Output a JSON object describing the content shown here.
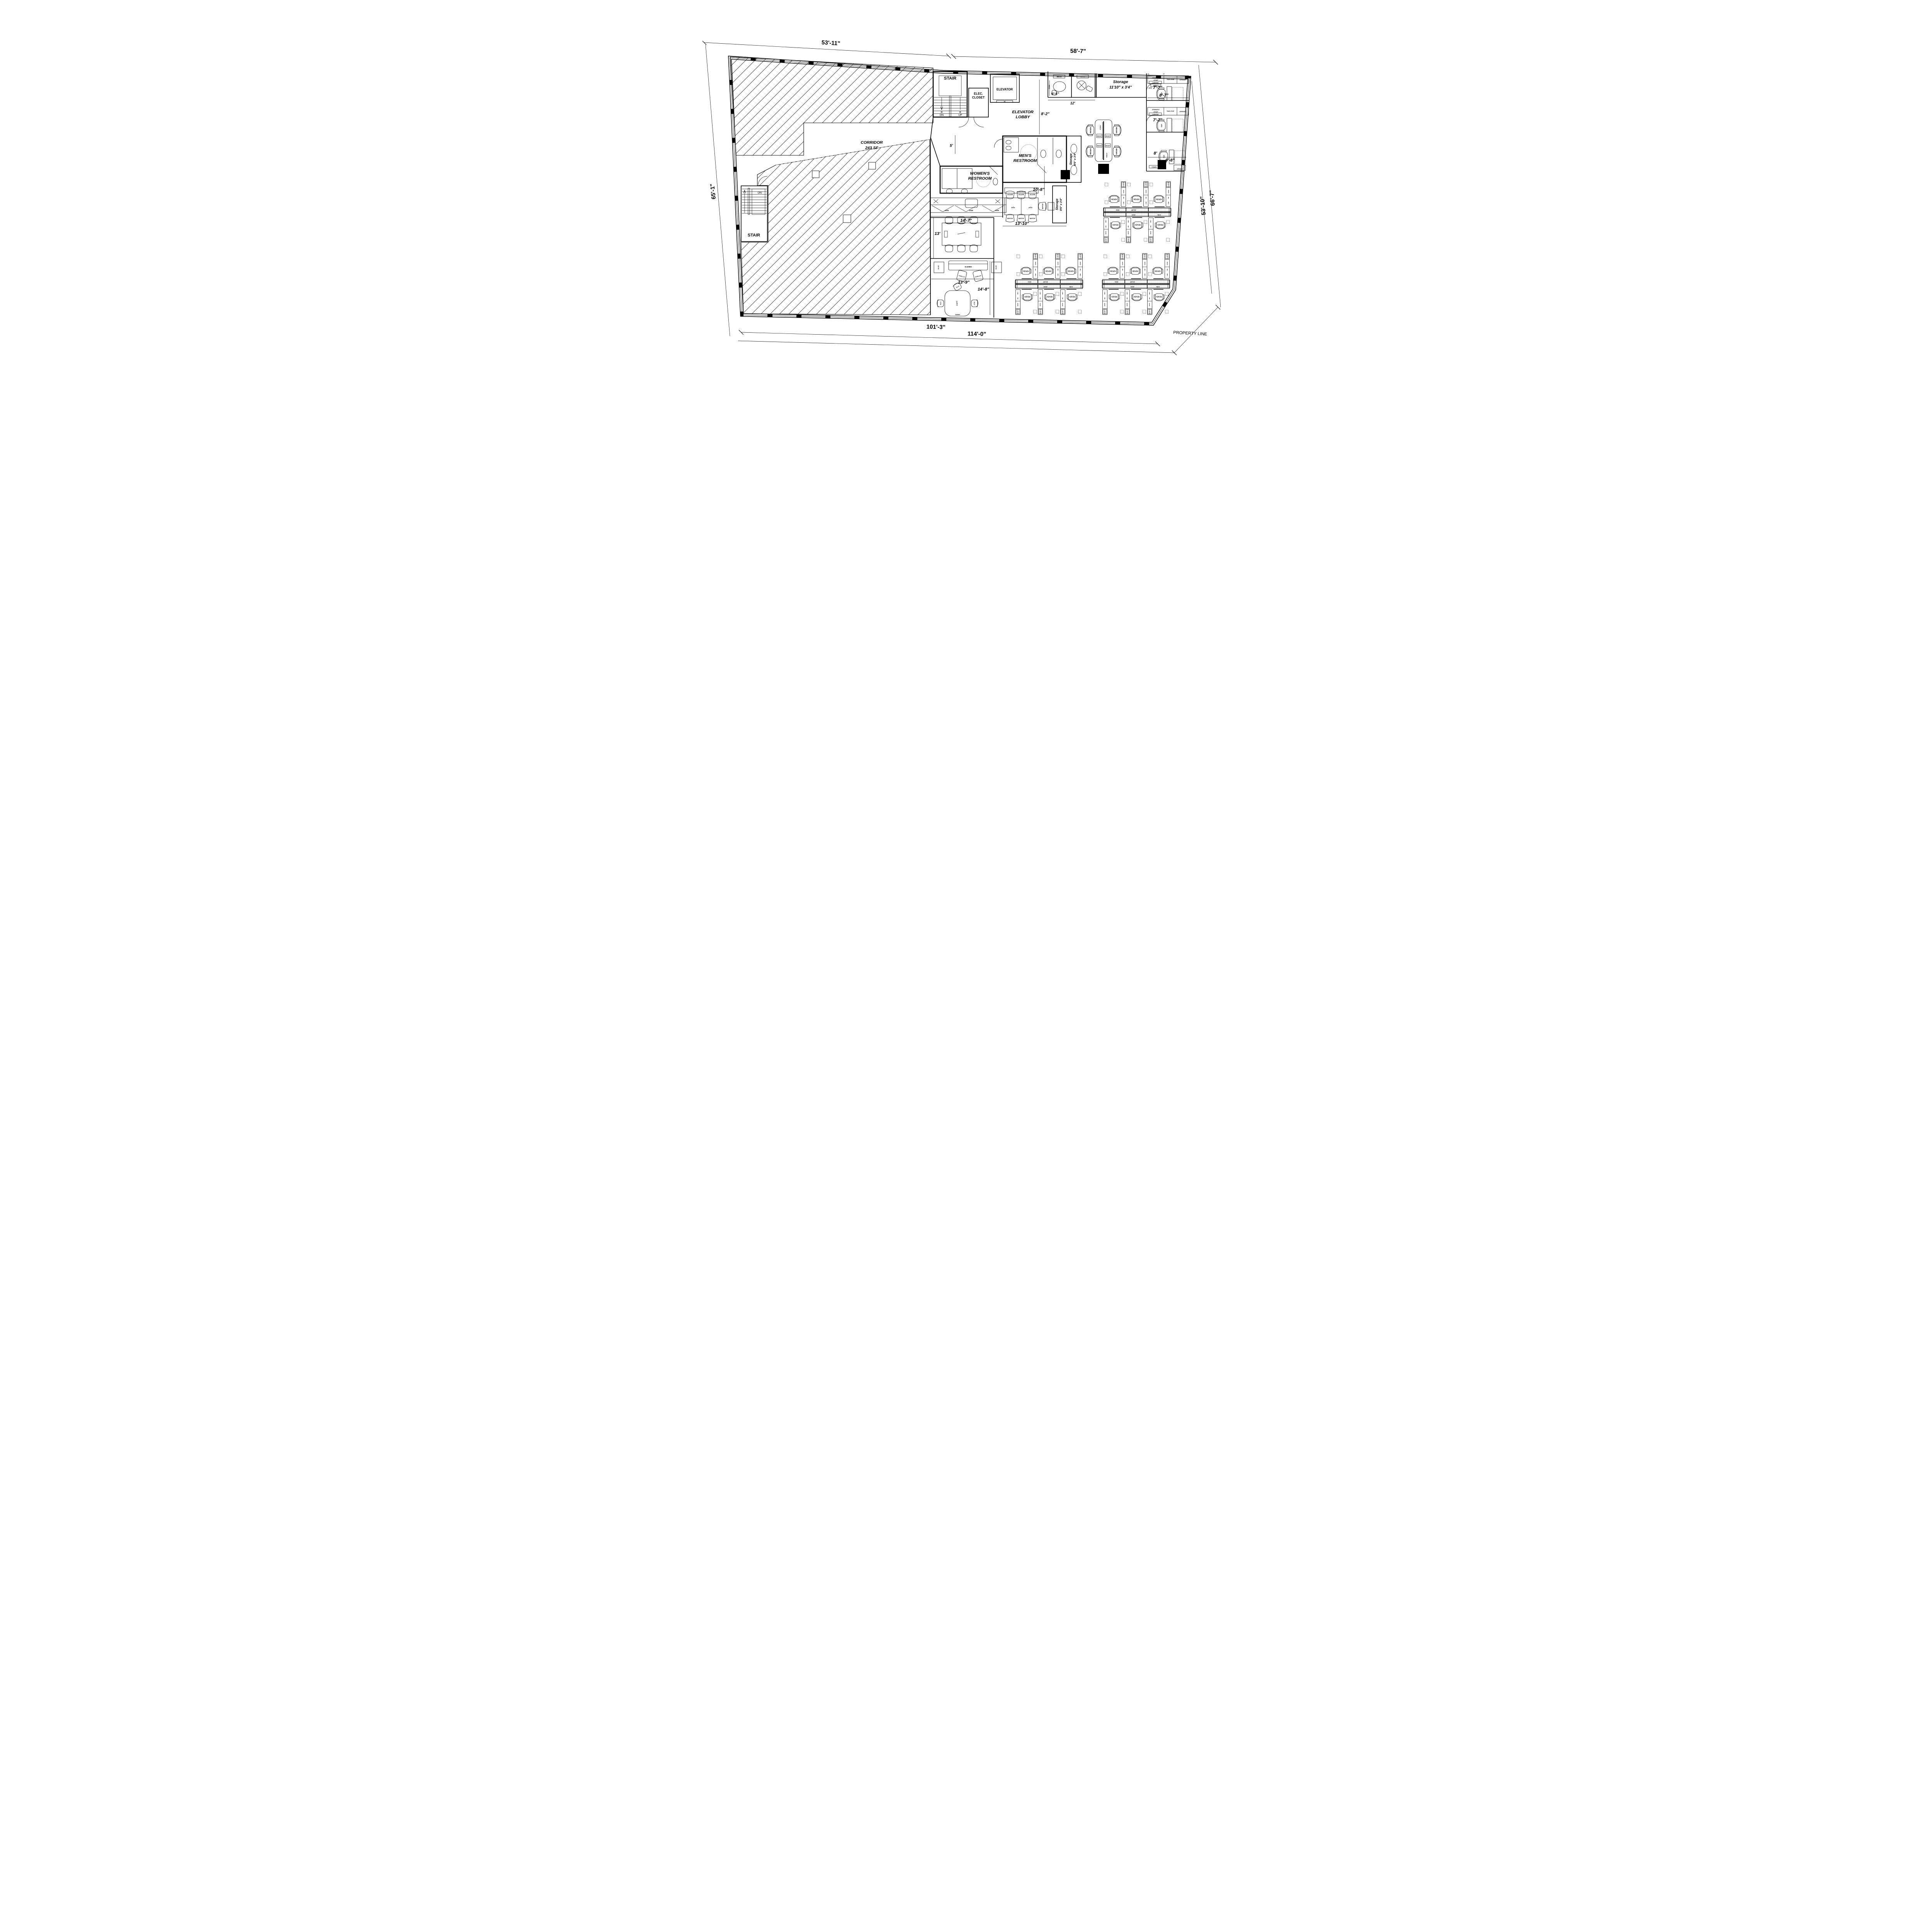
{
  "labels": {
    "dim_53_11": "53'-11\"",
    "dim_58_7": "58'-7\"",
    "dim_65_1": "65'-1\"",
    "dim_66_7": "66'-7\"",
    "dim_53_10": "53'-10\"",
    "dim_101_3": "101'-3\"",
    "dim_114_0": "114'-0\"",
    "property_line": "PROPERTY LINE",
    "stair": "STAIR",
    "stair_left": "STAIR",
    "dn": "DN",
    "up": "UP",
    "dn_left": "DN",
    "elec_1": "ELEC.",
    "elec_2": "CLOSET",
    "elevator": "ELEVATOR",
    "lobby_1": "ELEVATOR",
    "lobby_2": "LOBBY",
    "corridor_1": "CORRIDOR",
    "corridor_2": "243 SF",
    "mens_1": "MEN'S",
    "mens_2": "RESTROOM",
    "womens_1": "WOMEN'S",
    "womens_2": "RESTROOM",
    "storage_top_1": "Storage",
    "storage_top_2": "11'10\" x 3'4\"",
    "storage_side": "Storage",
    "storage_side_size": "8'6\" x 3'4\"",
    "storage_low": "Storage",
    "storage_low_size": "8'6\" x 3'4\"",
    "dim_6_5": "6'-5\"",
    "dim_12": "12'",
    "dim_8_2": "8'-2\"",
    "dim_5": "5'",
    "office1_w": "7'-7\"",
    "office1_d": "8'-7\"",
    "office2_w": "7'-7\"",
    "office3_w": "8'",
    "office3_d": "9'-8\"",
    "dim_10_8": "10'-8\"",
    "dim_13_10": "13'-10\"",
    "dim_14_7": "14'-7\"",
    "dim_13": "13'",
    "dim_13_9": "13'-9\"",
    "dim_14_8": "14'-8\""
  },
  "furniture_codes": {
    "task_chair": "REGEN",
    "pedestal": "2 LOCK",
    "ped_a": "CF30F",
    "ped_b": "T48",
    "ped_c": "F18F",
    "rail_a": "RS69",
    "rail_b": "RE72",
    "clamp": "DCLMP",
    "power": "DFOF",
    "monitor": "WEXBY",
    "monitor_arm": "XYZKCL",
    "exec_chair": "GEN",
    "office_cab_1": "SPW64/FO",
    "office_cab_2": "CF30F",
    "office_cab_3": "T8420 CF24F",
    "office_cab_4": "OPEN30F",
    "office_cab_5": "LCWKIT09",
    "office_cab_6": "KSPEC3",
    "office_cab_7": "64/FD",
    "meeting_table": "RMC36",
    "office_table_tag": "70/36M",
    "guest_chair": "BERTOIA",
    "side_table_sq": "SQ42",
    "cafe_chair": "OLLO",
    "cafe_table": "6060S1",
    "cafe_center": "SHEPP",
    "sofa": "KL6HBG",
    "side_table": "KL10G",
    "lounge_chair": "ACTTB2GL",
    "base_cabinet": "36/BB",
    "credenza": "C6016-F30/O30",
    "easel": "50SLDLSK",
    "wall_tag_fc": "FC",
    "wall_tag_ft": "FT"
  }
}
